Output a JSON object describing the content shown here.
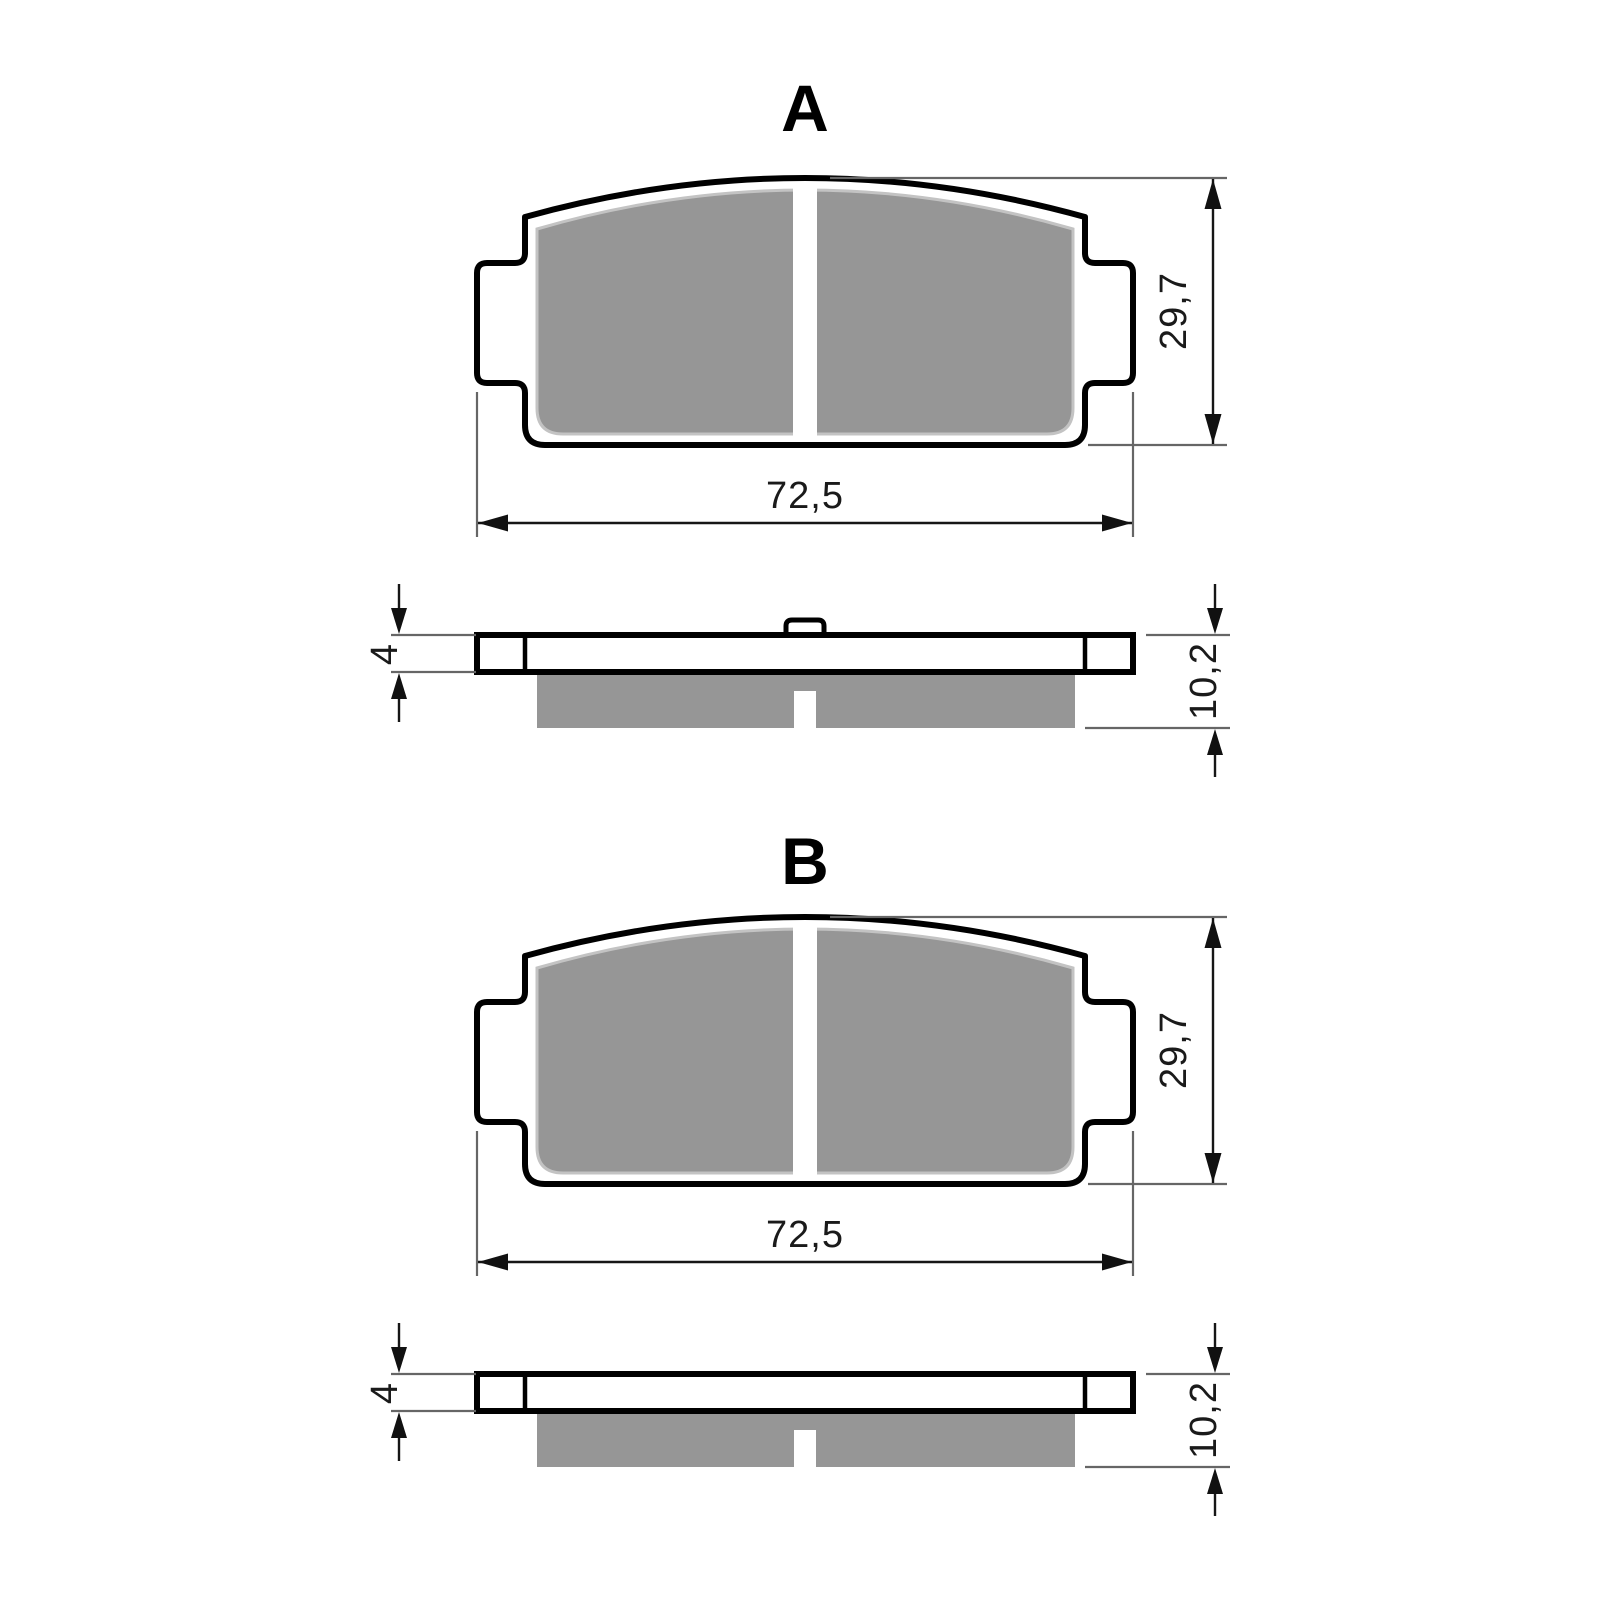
{
  "drawing": {
    "type": "brake-pad-dimension-drawing",
    "background": "#ffffff"
  },
  "colors": {
    "friction_material": "#969696",
    "friction_edge_highlight": "#c3c3c3",
    "outline": "#000000",
    "dimension_line": "#161616",
    "extension_line": "#666666",
    "text": "#1a1a1a"
  },
  "figures": [
    {
      "label": "A",
      "front_view": {
        "width_mm": "72,5",
        "height_mm": "29,7"
      },
      "side_view": {
        "plate_thickness_mm": "4",
        "total_thickness_mm": "10,2",
        "has_center_nub": true
      }
    },
    {
      "label": "B",
      "front_view": {
        "width_mm": "72,5",
        "height_mm": "29,7"
      },
      "side_view": {
        "plate_thickness_mm": "4",
        "total_thickness_mm": "10,2",
        "has_center_nub": false
      }
    }
  ]
}
